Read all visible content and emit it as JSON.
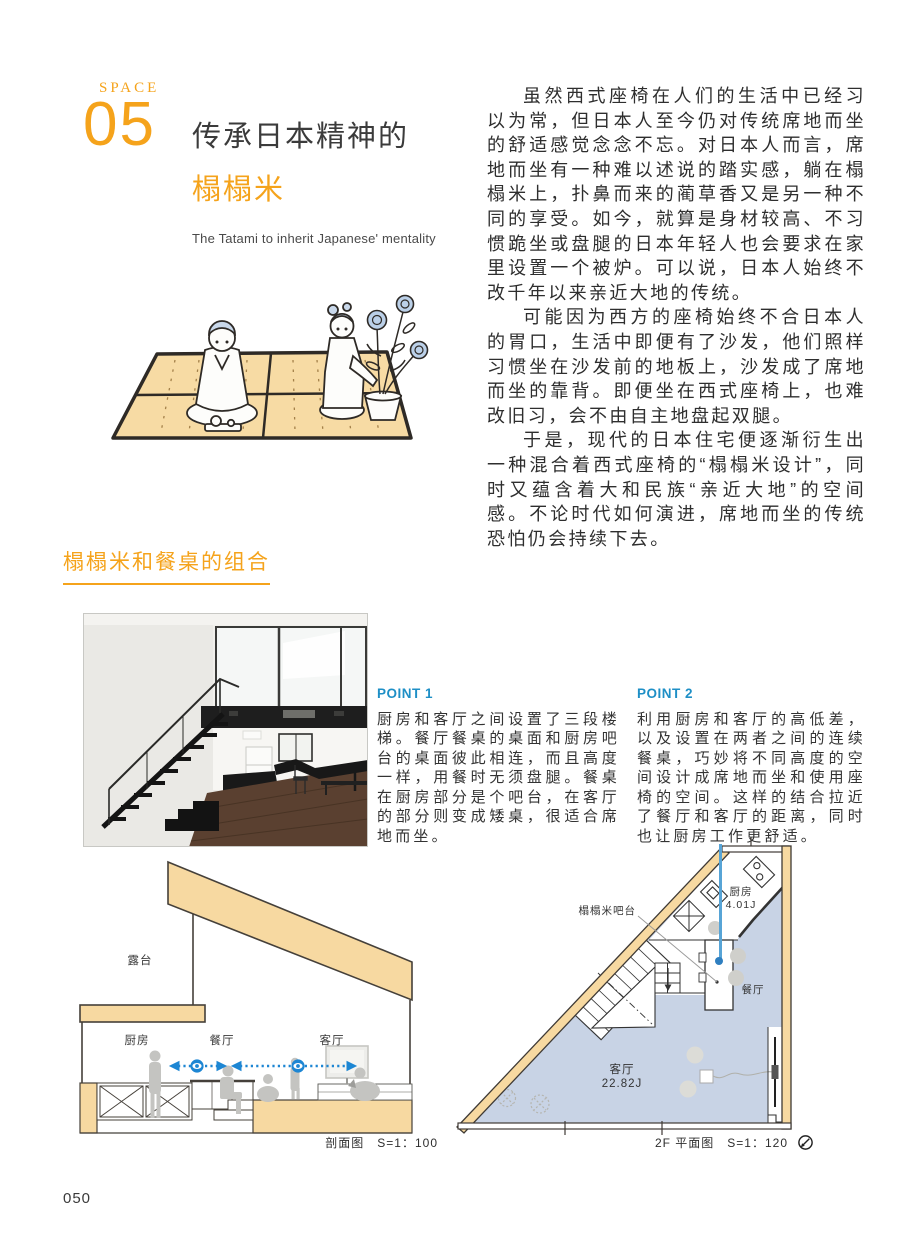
{
  "header": {
    "space_label": "SPACE",
    "space_number": "05",
    "title_line1": "传承日本精神的",
    "title_line2": "榻榻米",
    "subtitle": "The Tatami to inherit Japanese' mentality"
  },
  "intro_paragraphs": [
    "虽然西式座椅在人们的生活中已经习以为常，但日本人至今仍对传统席地而坐的舒适感觉念念不忘。对日本人而言，席地而坐有一种难以述说的踏实感，躺在榻榻米上，扑鼻而来的蔺草香又是另一种不同的享受。如今，就算是身材较高、不习惯跪坐或盘腿的日本年轻人也会要求在家里设置一个被炉。可以说，日本人始终不改千年以来亲近大地的传统。",
    "可能因为西方的座椅始终不合日本人的胃口，生活中即便有了沙发，他们照样习惯坐在沙发前的地板上，沙发成了席地而坐的靠背。即便坐在西式座椅上，也难改旧习，会不由自主地盘起双腿。",
    "于是，现代的日本住宅便逐渐衍生出一种混合着西式座椅的“榻榻米设计”，同时又蕴含着大和民族“亲近大地”的空间感。不论时代如何演进，席地而坐的传统恐怕仍会持续下去。"
  ],
  "section_heading": "榻榻米和餐桌的组合",
  "points": [
    {
      "label": "POINT 1",
      "text": "厨房和客厅之间设置了三段楼梯。餐厅餐桌的桌面和厨房吧台的桌面彼此相连，而且高度一样，用餐时无须盘腿。餐桌在厨房部分是个吧台，在客厅的部分则变成矮桌，很适合席地而坐。"
    },
    {
      "label": "POINT 2",
      "text": "利用厨房和客厅的高低差，以及设置在两者之间的连续餐桌，巧妙将不同高度的空间设计成席地而坐和使用座椅的空间。这样的结合拉近了餐厅和客厅的距离，同时也让厨房工作更舒适。"
    }
  ],
  "section_diagram": {
    "label_terrace": "露台",
    "label_kitchen": "厨房",
    "label_dining": "餐厅",
    "label_living": "客厅",
    "caption": "剖面图　S=1：100"
  },
  "floor_plan": {
    "label_tatami_bar": "榻榻米吧台",
    "label_kitchen": "厨房",
    "kitchen_area": "4.01J",
    "label_dining": "餐厅",
    "label_living": "客厅",
    "living_area": "22.82J",
    "caption": "2F 平面图　S=1：120"
  },
  "footer": {
    "page_number": "050"
  },
  "colors": {
    "accent_orange": "#F5A31B",
    "point_blue": "#1E8FC6",
    "sightline_blue": "#1D86D3",
    "wood_tan": "#F7D9A1",
    "plan_floor_blue": "#C8D3E5"
  }
}
